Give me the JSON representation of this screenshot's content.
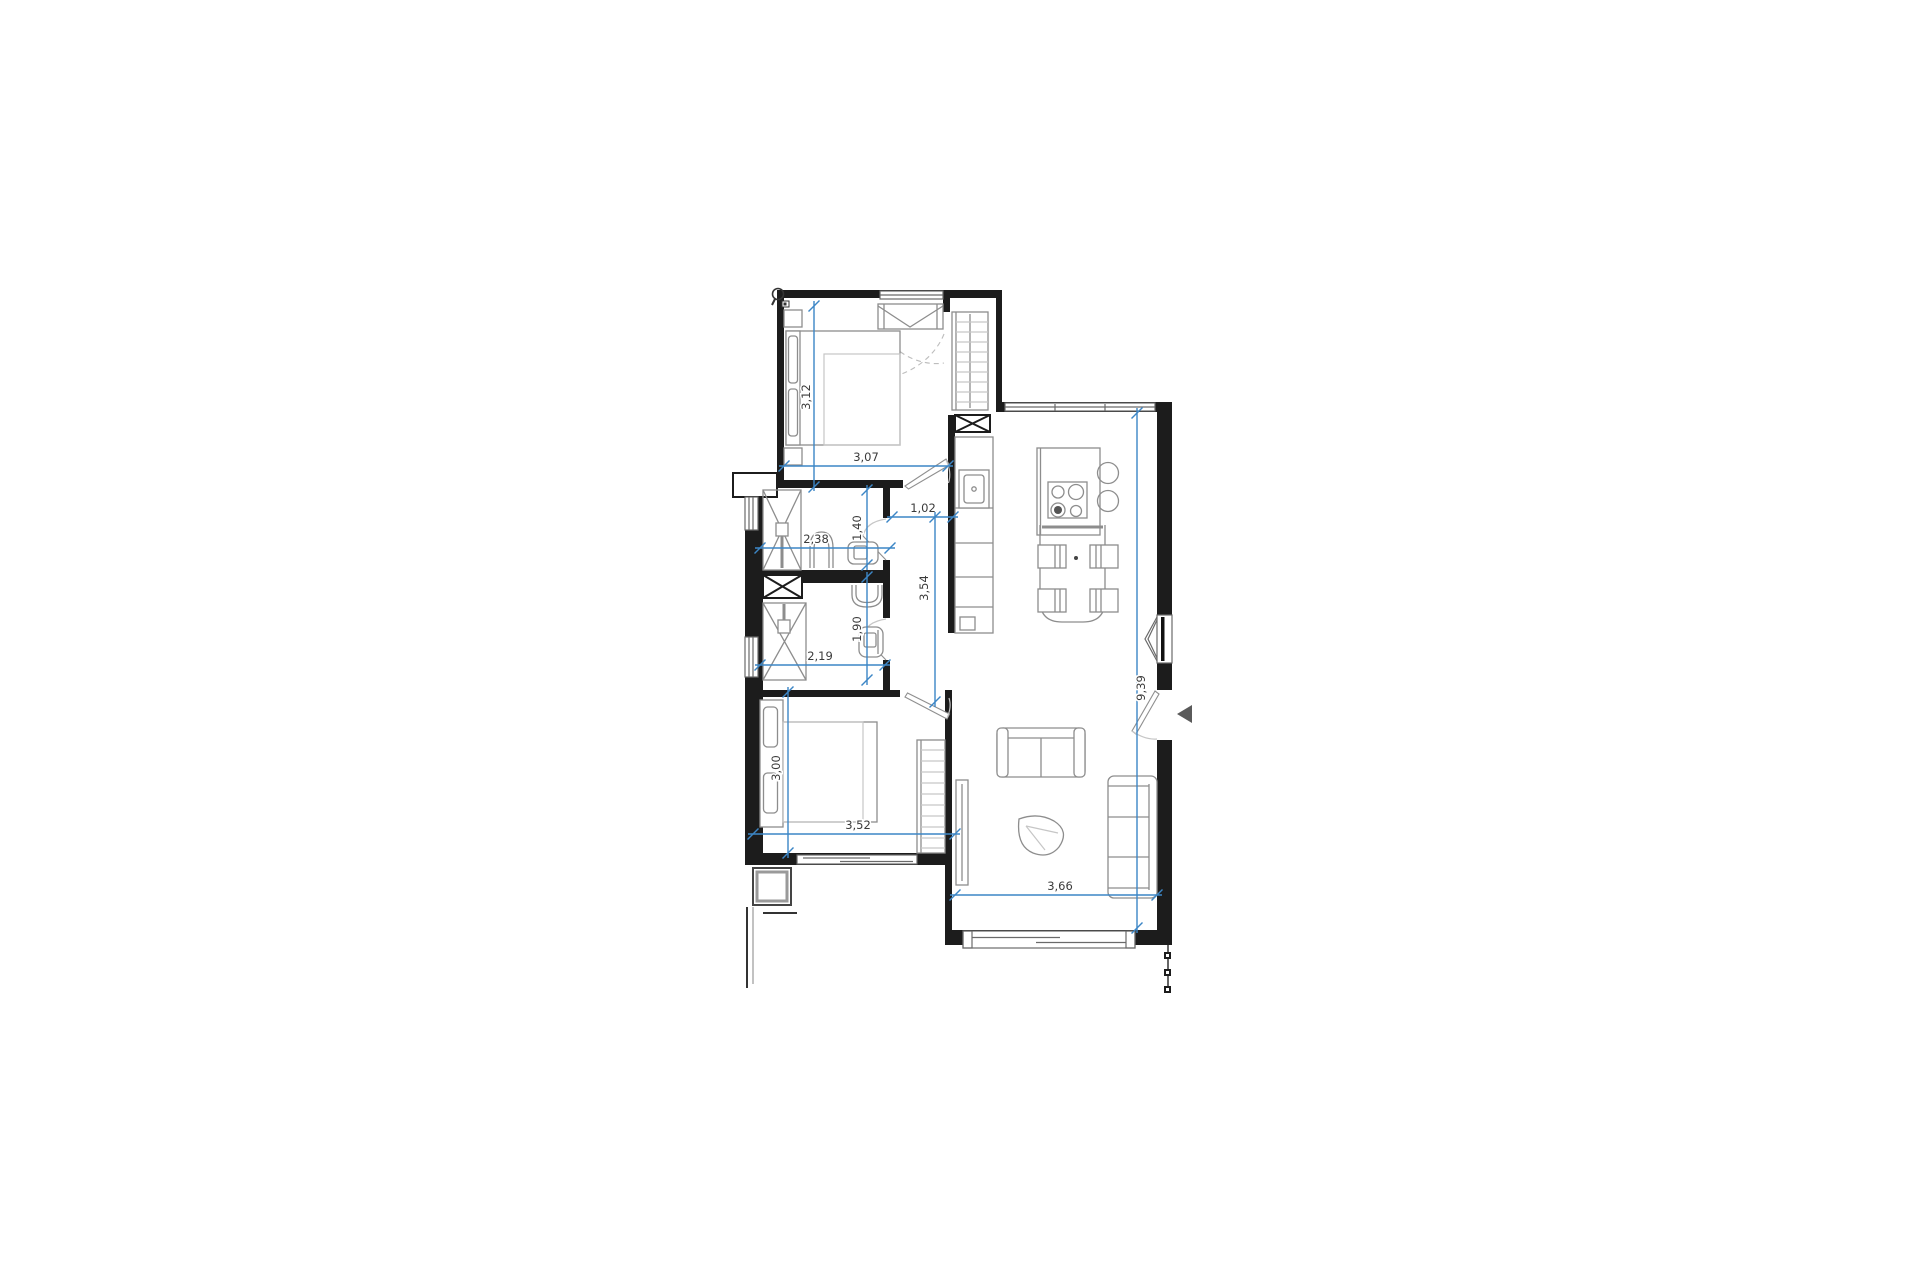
{
  "plan": {
    "dimensions": {
      "bedroom1_depth": "3,12",
      "bedroom1_width": "3,07",
      "hallway_width": "1,02",
      "bathroom1_width": "2,38",
      "bathroom1_depth": "1,40",
      "hallway_length": "3,54",
      "bathroom2_depth": "1,90",
      "bathroom2_width": "2,19",
      "living_length": "9,39",
      "bedroom2_depth": "3,00",
      "bedroom2_width": "3,52",
      "living_width": "3,66"
    },
    "colors": {
      "wall": "#1c1c1c",
      "furniture": "#8d8d8d",
      "dimension_line": "#3c86c6",
      "dimension_text": "#3a3a3a"
    }
  }
}
